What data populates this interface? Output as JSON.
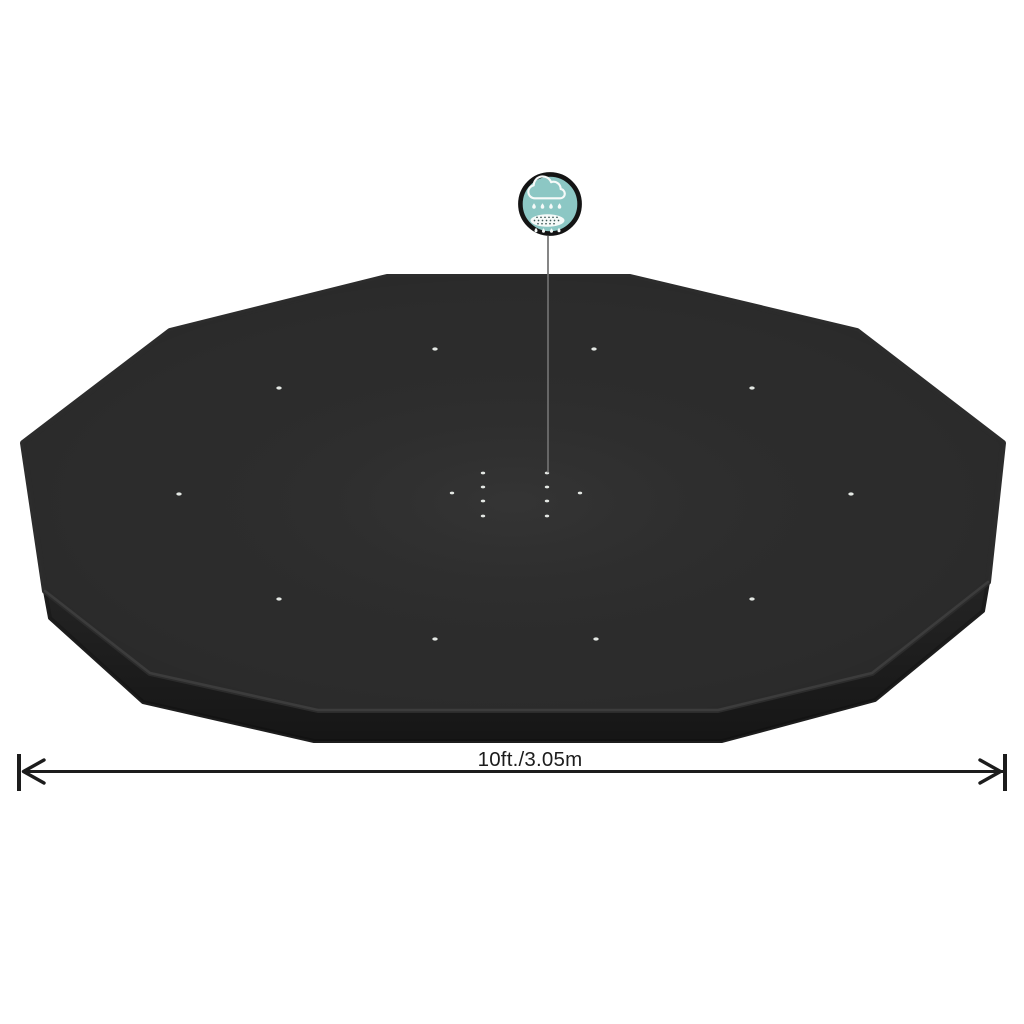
{
  "cover": {
    "top_color": "#2c2c2c",
    "side_color": "#242424",
    "side_rim_color": "#1d1d1d",
    "crease_highlight_color": "#3e3e3e",
    "hole_color": "#e4e8e4",
    "grommet_dots": [
      [
        435,
        349
      ],
      [
        594,
        349
      ],
      [
        279,
        388
      ],
      [
        752,
        388
      ],
      [
        179,
        494
      ],
      [
        851,
        494
      ],
      [
        279,
        599
      ],
      [
        752,
        599
      ],
      [
        435,
        639
      ],
      [
        596,
        639
      ]
    ],
    "drain_dots": [
      [
        483,
        473
      ],
      [
        483,
        487
      ],
      [
        483,
        501
      ],
      [
        483,
        516
      ],
      [
        547,
        473
      ],
      [
        547,
        487
      ],
      [
        547,
        501
      ],
      [
        547,
        516
      ],
      [
        452,
        493
      ],
      [
        580,
        493
      ]
    ]
  },
  "feature_icon": {
    "name": "rain-drainage",
    "circle_fill": "#8cc7c4",
    "ring_color": "#141414",
    "glyph_color": "#f6faf9",
    "sieve_speckle_color": "#3c5856"
  },
  "pointer_line": {
    "color": "#707070"
  },
  "dimension": {
    "label": "10ft./3.05m",
    "line_color": "#1c1c1c",
    "text_color": "#1c1c1c"
  }
}
